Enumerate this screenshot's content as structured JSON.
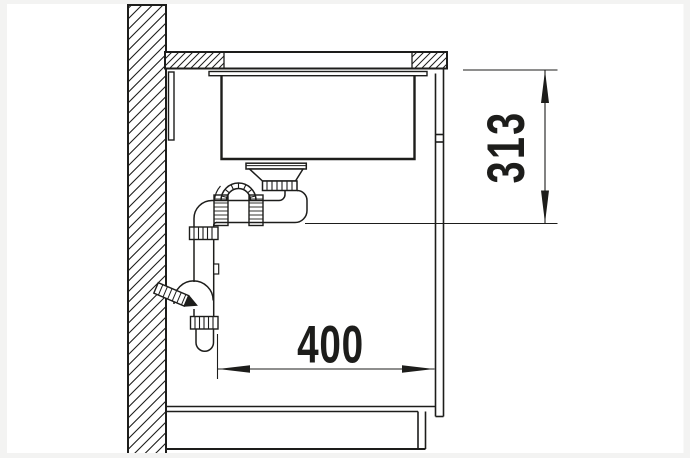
{
  "page": {
    "background": "#ffffff",
    "frame_color": "#f3f3f2",
    "line_color": "#1d1d1b"
  },
  "drawing": {
    "kind": "sink-installation-side-section",
    "dimensions": {
      "depth": {
        "label": "400"
      },
      "height": {
        "label": "313"
      }
    }
  }
}
